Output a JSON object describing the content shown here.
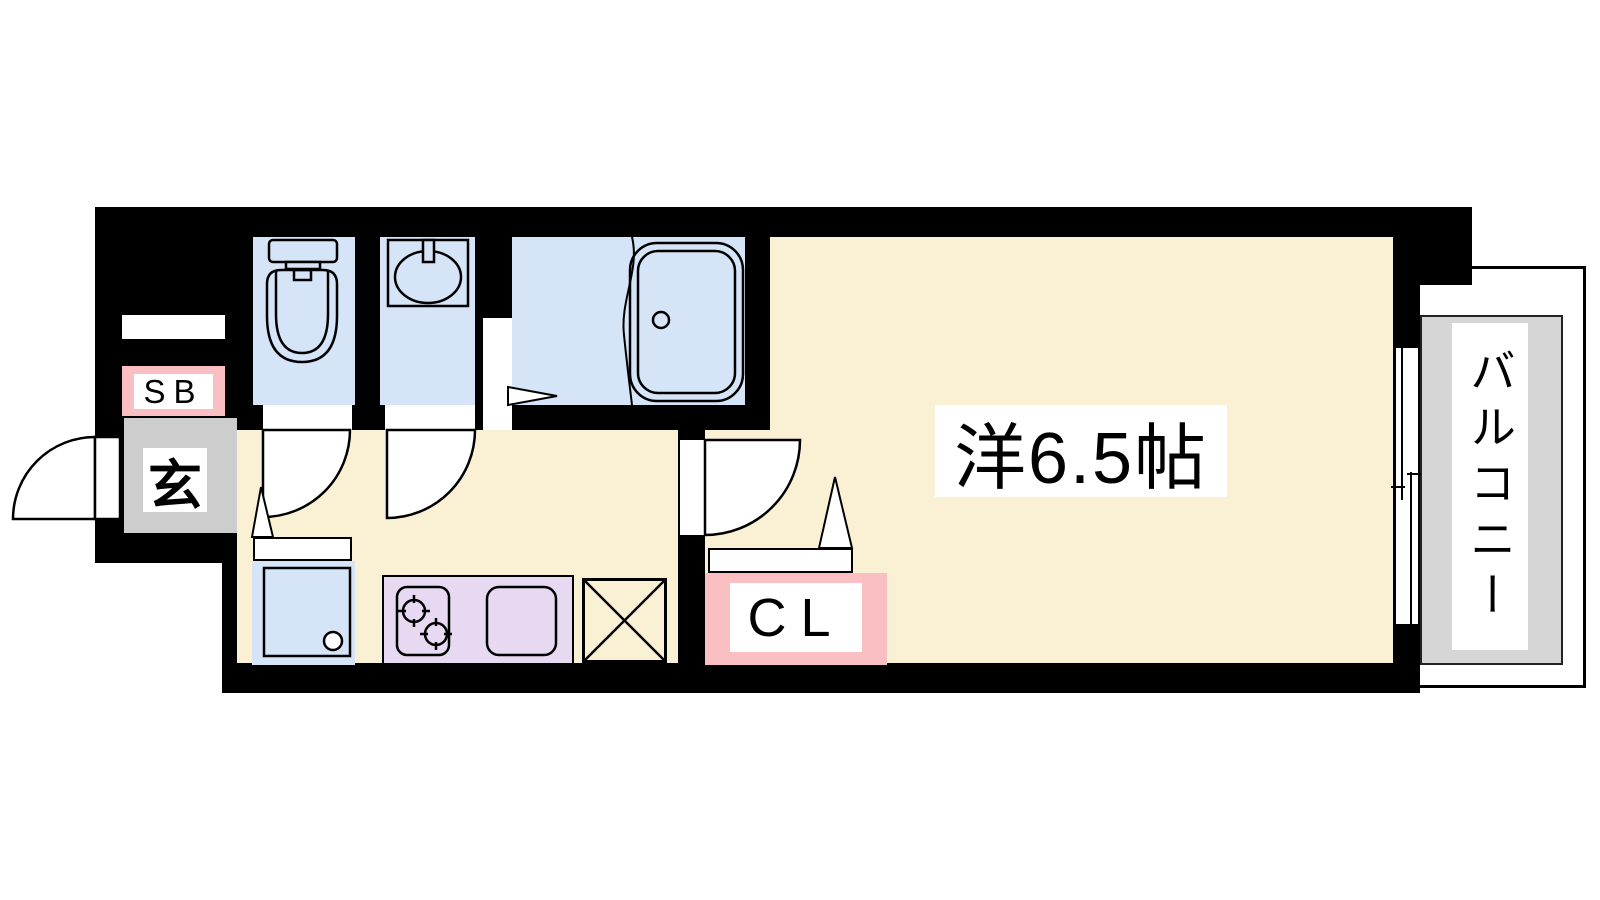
{
  "colors": {
    "wall": "#000000",
    "floor": "#faf0d4",
    "water": "#d5e4f7",
    "kitchen": "#e7d9f1",
    "pink": "#f9bfc3",
    "genkan-gray": "#cdcdcd",
    "balcony-gray": "#d6d6d6"
  },
  "rooms": {
    "main_room": {
      "label": "洋6.5帖"
    },
    "balcony": {
      "label": "バルコニー"
    },
    "entrance": {
      "label": "玄"
    },
    "shoe_box": {
      "label": "SB"
    },
    "closet": {
      "label": "CL"
    }
  }
}
